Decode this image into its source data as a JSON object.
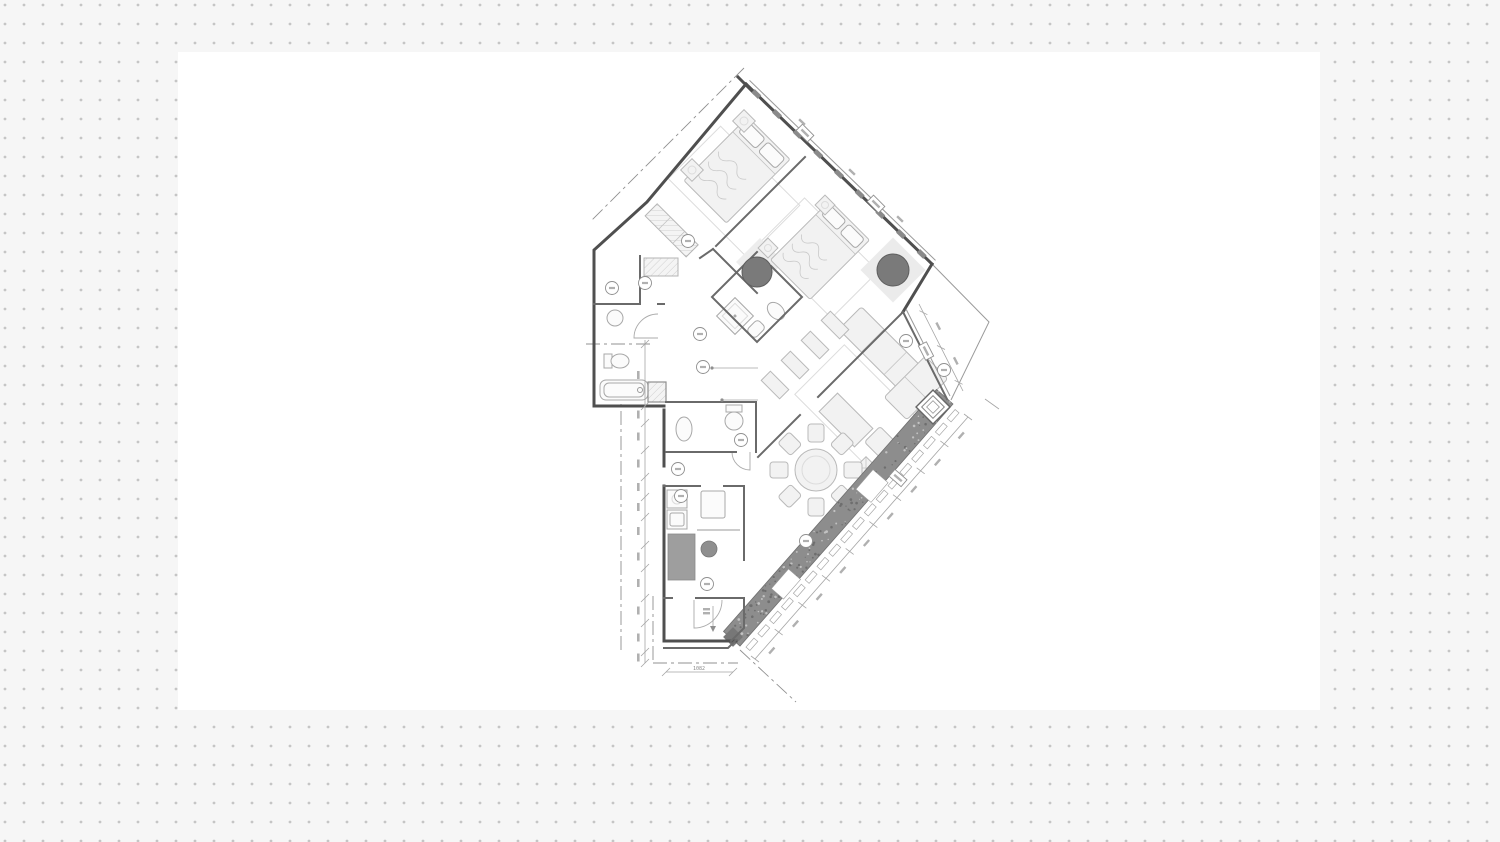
{
  "app": {
    "name": "drawing-canvas",
    "view": "architectural floor plan on dotted canvas"
  },
  "palette": {
    "background": "#f6f6f6",
    "dot": "#c5c5c5",
    "sheet": "#ffffff",
    "wall": "#4f4f4f",
    "wall_secondary": "#6a6a6a",
    "thin_line": "#9a9a9a",
    "furniture_fill": "#f2f2f2",
    "furniture_stroke": "#b9b9b9",
    "facade_band": "#8d8d8d",
    "facade_band_edge": "#6f6f6f",
    "column": "#7a7a7a",
    "kitchen_island": "#9e9e9e",
    "dimension_line": "#a5a5a5",
    "dashdot_line": "#909090"
  },
  "plan": {
    "type": "apartment-floor-plan",
    "wing_rotation_deg": 45,
    "rooms": [
      "bedroom-1",
      "bedroom-2",
      "ensuite-bathroom",
      "bathroom",
      "guest-wc",
      "dressing",
      "corridor",
      "kitchen",
      "entry",
      "living-room",
      "dining-area",
      "balcony"
    ],
    "dining": {
      "chairs": 8,
      "table_shape": "round"
    },
    "columns": {
      "round": 2,
      "square": 1
    },
    "beds": 2,
    "dimension_labels": {
      "bottom": "1082"
    },
    "window_tags": 4,
    "reference_tags": 12
  }
}
